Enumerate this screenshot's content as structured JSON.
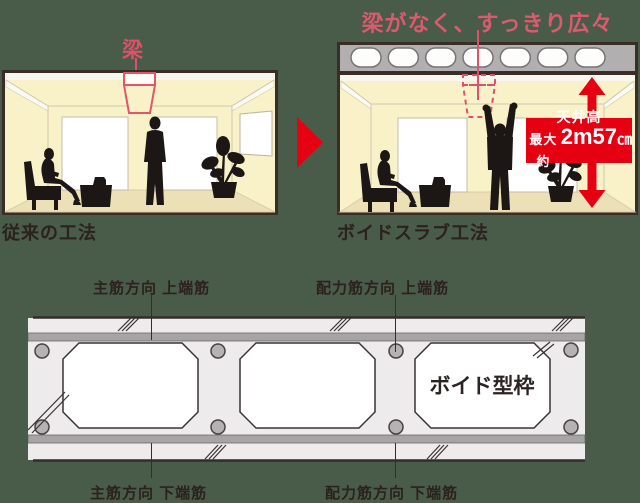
{
  "colors": {
    "background": "#495b49",
    "accent_red": "#e50012",
    "accent_pink": "#db5a6e",
    "outline_dark": "#3a2d26",
    "text_dark": "#2b211d",
    "wall_yellow": "#f9f2c8",
    "floor_beige": "#ece0b6",
    "slab_gray": "#b2afb0",
    "section_concrete": "#edebec",
    "section_rebar_band": "#a7a4a5"
  },
  "icons": {
    "comparison_arrow": "comparison-arrow-icon",
    "ceiling_height_arrow": "ceiling-height-arrow-icon"
  },
  "comparison": {
    "before": {
      "beam_label": "梁",
      "caption": "従来の工法"
    },
    "after": {
      "headline": "梁がなく、すっきり広々",
      "caption": "ボイドスラブ工法",
      "height_callout": {
        "line1": "天井高",
        "prefix": "最大 約",
        "value": "2m57",
        "unit": "㎝"
      }
    }
  },
  "cross_section": {
    "labels": {
      "top_left": "主筋方向 上端筋",
      "top_right": "配力筋方向 上端筋",
      "bottom_left": "主筋方向 下端筋",
      "bottom_right": "配力筋方向 下端筋"
    },
    "void_form_label": "ボイド型枠"
  }
}
